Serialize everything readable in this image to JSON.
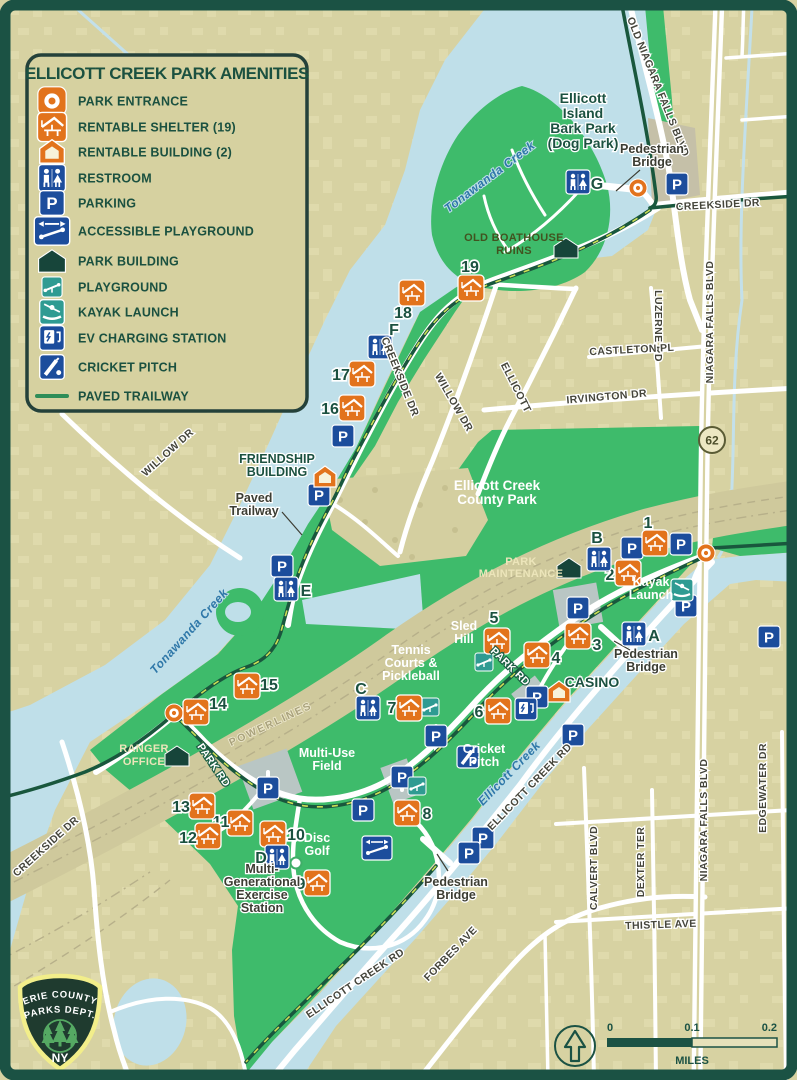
{
  "legend": {
    "title": "ELLICOTT CREEK PARK AMENITIES",
    "items": [
      {
        "icon": "entrance-sq",
        "label": "PARK ENTRANCE"
      },
      {
        "icon": "shelter",
        "label": "RENTABLE SHELTER (19)"
      },
      {
        "icon": "building",
        "label": "RENTABLE BUILDING (2)"
      },
      {
        "icon": "restroom",
        "label": "RESTROOM"
      },
      {
        "icon": "parking",
        "label": "PARKING"
      },
      {
        "icon": "accessible",
        "label": "ACCESSIBLE PLAYGROUND"
      },
      {
        "icon": "parkbldg",
        "label": "PARK BUILDING"
      },
      {
        "icon": "playground",
        "label": "PLAYGROUND"
      },
      {
        "icon": "kayak",
        "label": "KAYAK LAUNCH"
      },
      {
        "icon": "ev",
        "label": "EV CHARGING STATION"
      },
      {
        "icon": "cricket",
        "label": "CRICKET PITCH"
      },
      {
        "icon": "trail",
        "label": "PAVED TRAILWAY"
      }
    ]
  },
  "markers": {
    "shelters": [
      {
        "n": "1",
        "x": 655,
        "y": 543,
        "nx": 648,
        "ny": 528
      },
      {
        "n": "2",
        "x": 628,
        "y": 573,
        "nx": 610,
        "ny": 580
      },
      {
        "n": "3",
        "x": 578,
        "y": 636,
        "nx": 597,
        "ny": 650
      },
      {
        "n": "4",
        "x": 537,
        "y": 655,
        "nx": 556,
        "ny": 663
      },
      {
        "n": "5",
        "x": 497,
        "y": 641,
        "nx": 494,
        "ny": 623
      },
      {
        "n": "6",
        "x": 498,
        "y": 711,
        "nx": 479,
        "ny": 717
      },
      {
        "n": "7",
        "x": 409,
        "y": 708,
        "nx": 392,
        "ny": 713
      },
      {
        "n": "8",
        "x": 407,
        "y": 813,
        "nx": 427,
        "ny": 819
      },
      {
        "n": "9",
        "x": 317,
        "y": 883,
        "nx": 301,
        "ny": 889
      },
      {
        "n": "10",
        "x": 273,
        "y": 834,
        "nx": 296,
        "ny": 840
      },
      {
        "n": "11",
        "x": 240,
        "y": 823,
        "nx": 221,
        "ny": 827
      },
      {
        "n": "12",
        "x": 208,
        "y": 836,
        "nx": 188,
        "ny": 843
      },
      {
        "n": "13",
        "x": 202,
        "y": 806,
        "nx": 181,
        "ny": 812
      },
      {
        "n": "14",
        "x": 196,
        "y": 712,
        "nx": 218,
        "ny": 709
      },
      {
        "n": "15",
        "x": 247,
        "y": 686,
        "nx": 269,
        "ny": 690
      },
      {
        "n": "16",
        "x": 352,
        "y": 408,
        "nx": 330,
        "ny": 414
      },
      {
        "n": "17",
        "x": 362,
        "y": 374,
        "nx": 341,
        "ny": 380
      },
      {
        "n": "18",
        "x": 412,
        "y": 293,
        "nx": 403,
        "ny": 318
      },
      {
        "n": "19",
        "x": 471,
        "y": 288,
        "nx": 470,
        "ny": 272
      }
    ],
    "restrooms": [
      {
        "id": "A",
        "x": 634,
        "y": 634,
        "lx": 654,
        "ly": 641
      },
      {
        "id": "B",
        "x": 599,
        "y": 559,
        "lx": 597,
        "ly": 543
      },
      {
        "id": "C",
        "x": 368,
        "y": 708,
        "lx": 361,
        "ly": 694
      },
      {
        "id": "D",
        "x": 277,
        "y": 857,
        "lx": 261,
        "ly": 863
      },
      {
        "id": "E",
        "x": 286,
        "y": 589,
        "lx": 306,
        "ly": 596
      },
      {
        "id": "F",
        "x": 380,
        "y": 347,
        "lx": 394,
        "ly": 335
      },
      {
        "id": "G",
        "x": 578,
        "y": 182,
        "lx": 597,
        "ly": 189
      }
    ],
    "parking": [
      [
        677,
        184
      ],
      [
        343,
        436
      ],
      [
        319,
        495
      ],
      [
        282,
        566
      ],
      [
        632,
        548
      ],
      [
        681,
        544
      ],
      [
        686,
        606
      ],
      [
        578,
        608
      ],
      [
        537,
        697
      ],
      [
        573,
        735
      ],
      [
        436,
        736
      ],
      [
        402,
        777
      ],
      [
        363,
        810
      ],
      [
        268,
        788
      ],
      [
        483,
        838
      ],
      [
        469,
        853
      ],
      [
        769,
        637
      ]
    ],
    "entrances": [
      [
        638,
        188
      ],
      [
        706,
        553
      ],
      [
        174,
        713
      ]
    ],
    "rentable_buildings": [
      [
        325,
        477
      ],
      [
        559,
        692
      ]
    ],
    "park_buildings": [
      [
        566,
        248
      ],
      [
        569,
        568
      ],
      [
        177,
        756
      ]
    ],
    "playgrounds": [
      [
        484,
        662
      ],
      [
        430,
        707
      ],
      [
        417,
        786
      ]
    ],
    "accessible_playgrounds": [
      [
        377,
        848
      ]
    ],
    "kayak_launches": [
      [
        682,
        590
      ]
    ],
    "ev_stations": [
      [
        526,
        709
      ]
    ],
    "cricket_pitches": [
      [
        468,
        757
      ]
    ],
    "exercise_stations": [
      [
        296,
        863
      ]
    ]
  },
  "map_labels": [
    {
      "lines": [
        "Ellicott",
        "Island",
        "Bark Park",
        "(Dog Park)"
      ],
      "x": 583,
      "y": 103,
      "cls": "lbl-green-lg",
      "lh": 15
    },
    {
      "lines": [
        "Pedestrian",
        "Bridge"
      ],
      "x": 652,
      "y": 153,
      "cls": "lbl-char",
      "lh": 13
    },
    {
      "lines": [
        "OLD BOATHOUSE",
        "RUINS"
      ],
      "x": 514,
      "y": 241,
      "cls": "lbl-olive",
      "lh": 13
    },
    {
      "lines": [
        "FRIENDSHIP",
        "BUILDING"
      ],
      "x": 277,
      "y": 463,
      "cls": "lbl-green",
      "lh": 13
    },
    {
      "lines": [
        "Paved",
        "Trailway"
      ],
      "x": 254,
      "y": 502,
      "cls": "lbl-char",
      "lh": 13
    },
    {
      "lines": [
        "Ellicott Creek",
        "County Park"
      ],
      "x": 497,
      "y": 490,
      "cls": "lbl-white-lg",
      "lh": 14
    },
    {
      "lines": [
        "PARK",
        "MAINTENANCE"
      ],
      "x": 521,
      "y": 565,
      "cls": "lbl-cream",
      "lh": 12
    },
    {
      "lines": [
        "Kayak",
        "Launch"
      ],
      "x": 651,
      "y": 586,
      "cls": "lbl-white",
      "lh": 13
    },
    {
      "lines": [
        "CASINO"
      ],
      "x": 592,
      "y": 687,
      "cls": "lbl-green-lg",
      "lh": 14
    },
    {
      "lines": [
        "Sled",
        "Hill"
      ],
      "x": 464,
      "y": 630,
      "cls": "lbl-white",
      "lh": 13
    },
    {
      "lines": [
        "Tennis",
        "Courts &",
        "Pickleball"
      ],
      "x": 411,
      "y": 654,
      "cls": "lbl-white",
      "lh": 13
    },
    {
      "lines": [
        "Cricket",
        "Pitch"
      ],
      "x": 484,
      "y": 753,
      "cls": "lbl-white",
      "lh": 13,
      "anchor": "start"
    },
    {
      "lines": [
        "Multi-Use",
        "Field"
      ],
      "x": 327,
      "y": 757,
      "cls": "lbl-white",
      "lh": 13
    },
    {
      "lines": [
        "RANGER",
        "OFFICE"
      ],
      "x": 144,
      "y": 752,
      "cls": "lbl-cream",
      "lh": 13
    },
    {
      "lines": [
        "Pedestrian",
        "Bridge"
      ],
      "x": 646,
      "y": 658,
      "cls": "lbl-char",
      "lh": 13
    },
    {
      "lines": [
        "Pedestrian",
        "Bridge"
      ],
      "x": 456,
      "y": 886,
      "cls": "lbl-char",
      "lh": 13
    },
    {
      "lines": [
        "Disc",
        "Golf"
      ],
      "x": 317,
      "y": 842,
      "cls": "lbl-white",
      "lh": 13
    },
    {
      "lines": [
        "Multi-",
        "Generational",
        "Exercise",
        "Station"
      ],
      "x": 262,
      "y": 873,
      "cls": "lbl-char",
      "lh": 13
    },
    {
      "lines": [
        "POWERLINES"
      ],
      "x": 272,
      "y": 727,
      "cls": "lbl-power",
      "rot": -25,
      "lh": 12
    }
  ],
  "road_labels": [
    {
      "text": "OLD NIAGARA FALLS BLVD",
      "x": 655,
      "y": 88,
      "rot": 68
    },
    {
      "text": "CREEKSIDE DR",
      "x": 718,
      "y": 208,
      "rot": -3
    },
    {
      "text": "NIAGARA FALLS BLVD",
      "x": 713,
      "y": 322,
      "rot": -90
    },
    {
      "text": "NIAGARA FALLS BLVD",
      "x": 707,
      "y": 820,
      "rot": -90
    },
    {
      "text": "LUZERNE RD",
      "x": 655,
      "y": 326,
      "rot": 90
    },
    {
      "text": "CASTLETON PL",
      "x": 632,
      "y": 353,
      "rot": -3
    },
    {
      "text": "IRVINGTON DR",
      "x": 607,
      "y": 400,
      "rot": -5
    },
    {
      "text": "ELLICOTT",
      "x": 513,
      "y": 389,
      "rot": 63
    },
    {
      "text": "WILLOW DR",
      "x": 451,
      "y": 404,
      "rot": 60
    },
    {
      "text": "CREEKSIDE DR",
      "x": 397,
      "y": 378,
      "rot": 68
    },
    {
      "text": "WILLOW DR",
      "x": 170,
      "y": 455,
      "rot": -42
    },
    {
      "text": "PARK RD",
      "x": 211,
      "y": 767,
      "rot": 56,
      "cls": "rd-park"
    },
    {
      "text": "PARK RD",
      "x": 508,
      "y": 669,
      "rot": 44,
      "cls": "rd-park"
    },
    {
      "text": "CREEKSIDE DR",
      "x": 48,
      "y": 849,
      "rot": -42
    },
    {
      "text": "ELLICOTT CREEK RD",
      "x": 532,
      "y": 789,
      "rot": -46
    },
    {
      "text": "ELLICOTT CREEK RD",
      "x": 357,
      "y": 986,
      "rot": -34
    },
    {
      "text": "FORBES AVE",
      "x": 453,
      "y": 956,
      "rot": -46
    },
    {
      "text": "CALVERT BLVD",
      "x": 597,
      "y": 868,
      "rot": -90
    },
    {
      "text": "DEXTER TER",
      "x": 644,
      "y": 862,
      "rot": -90
    },
    {
      "text": "EDGEWATER DR",
      "x": 766,
      "y": 788,
      "rot": -90
    },
    {
      "text": "THISTLE AVE",
      "x": 661,
      "y": 928,
      "rot": -2
    }
  ],
  "creek_labels": [
    {
      "text": "Tonawanda   Creek",
      "x": 492,
      "y": 180,
      "rot": -37
    },
    {
      "text": "Tonawanda   Creek",
      "x": 192,
      "y": 634,
      "rot": -48
    },
    {
      "text": "Ellicott   Creek",
      "x": 512,
      "y": 776,
      "rot": -46
    }
  ],
  "pointer_lines": [
    [
      640,
      170,
      616,
      191
    ],
    [
      282,
      512,
      302,
      535
    ],
    [
      630,
      650,
      614,
      641
    ],
    [
      448,
      871,
      437,
      854
    ],
    [
      274,
      866,
      291,
      863
    ]
  ],
  "route_shield": {
    "text": "62",
    "x": 712,
    "y": 440
  },
  "scalebar": {
    "labels": [
      "0",
      "0.1",
      "0.2"
    ],
    "unit": "MILES"
  },
  "logo": {
    "arc1": "ERIE COUNTY",
    "arc2": "PARKS DEPT.",
    "ny": "NY"
  },
  "colors": {
    "frame": "#1b5244",
    "land": "#d7d2a2",
    "water": "#bfdfe9",
    "park_green": "#3ebb6b",
    "trail": "#19573d",
    "orange": "#e2731c",
    "blue": "#1c4d9c",
    "teal": "#2f9b92",
    "dark_building": "#17453a",
    "corridor": "#cfc99c",
    "legend_bg": "#d6d1a0"
  }
}
